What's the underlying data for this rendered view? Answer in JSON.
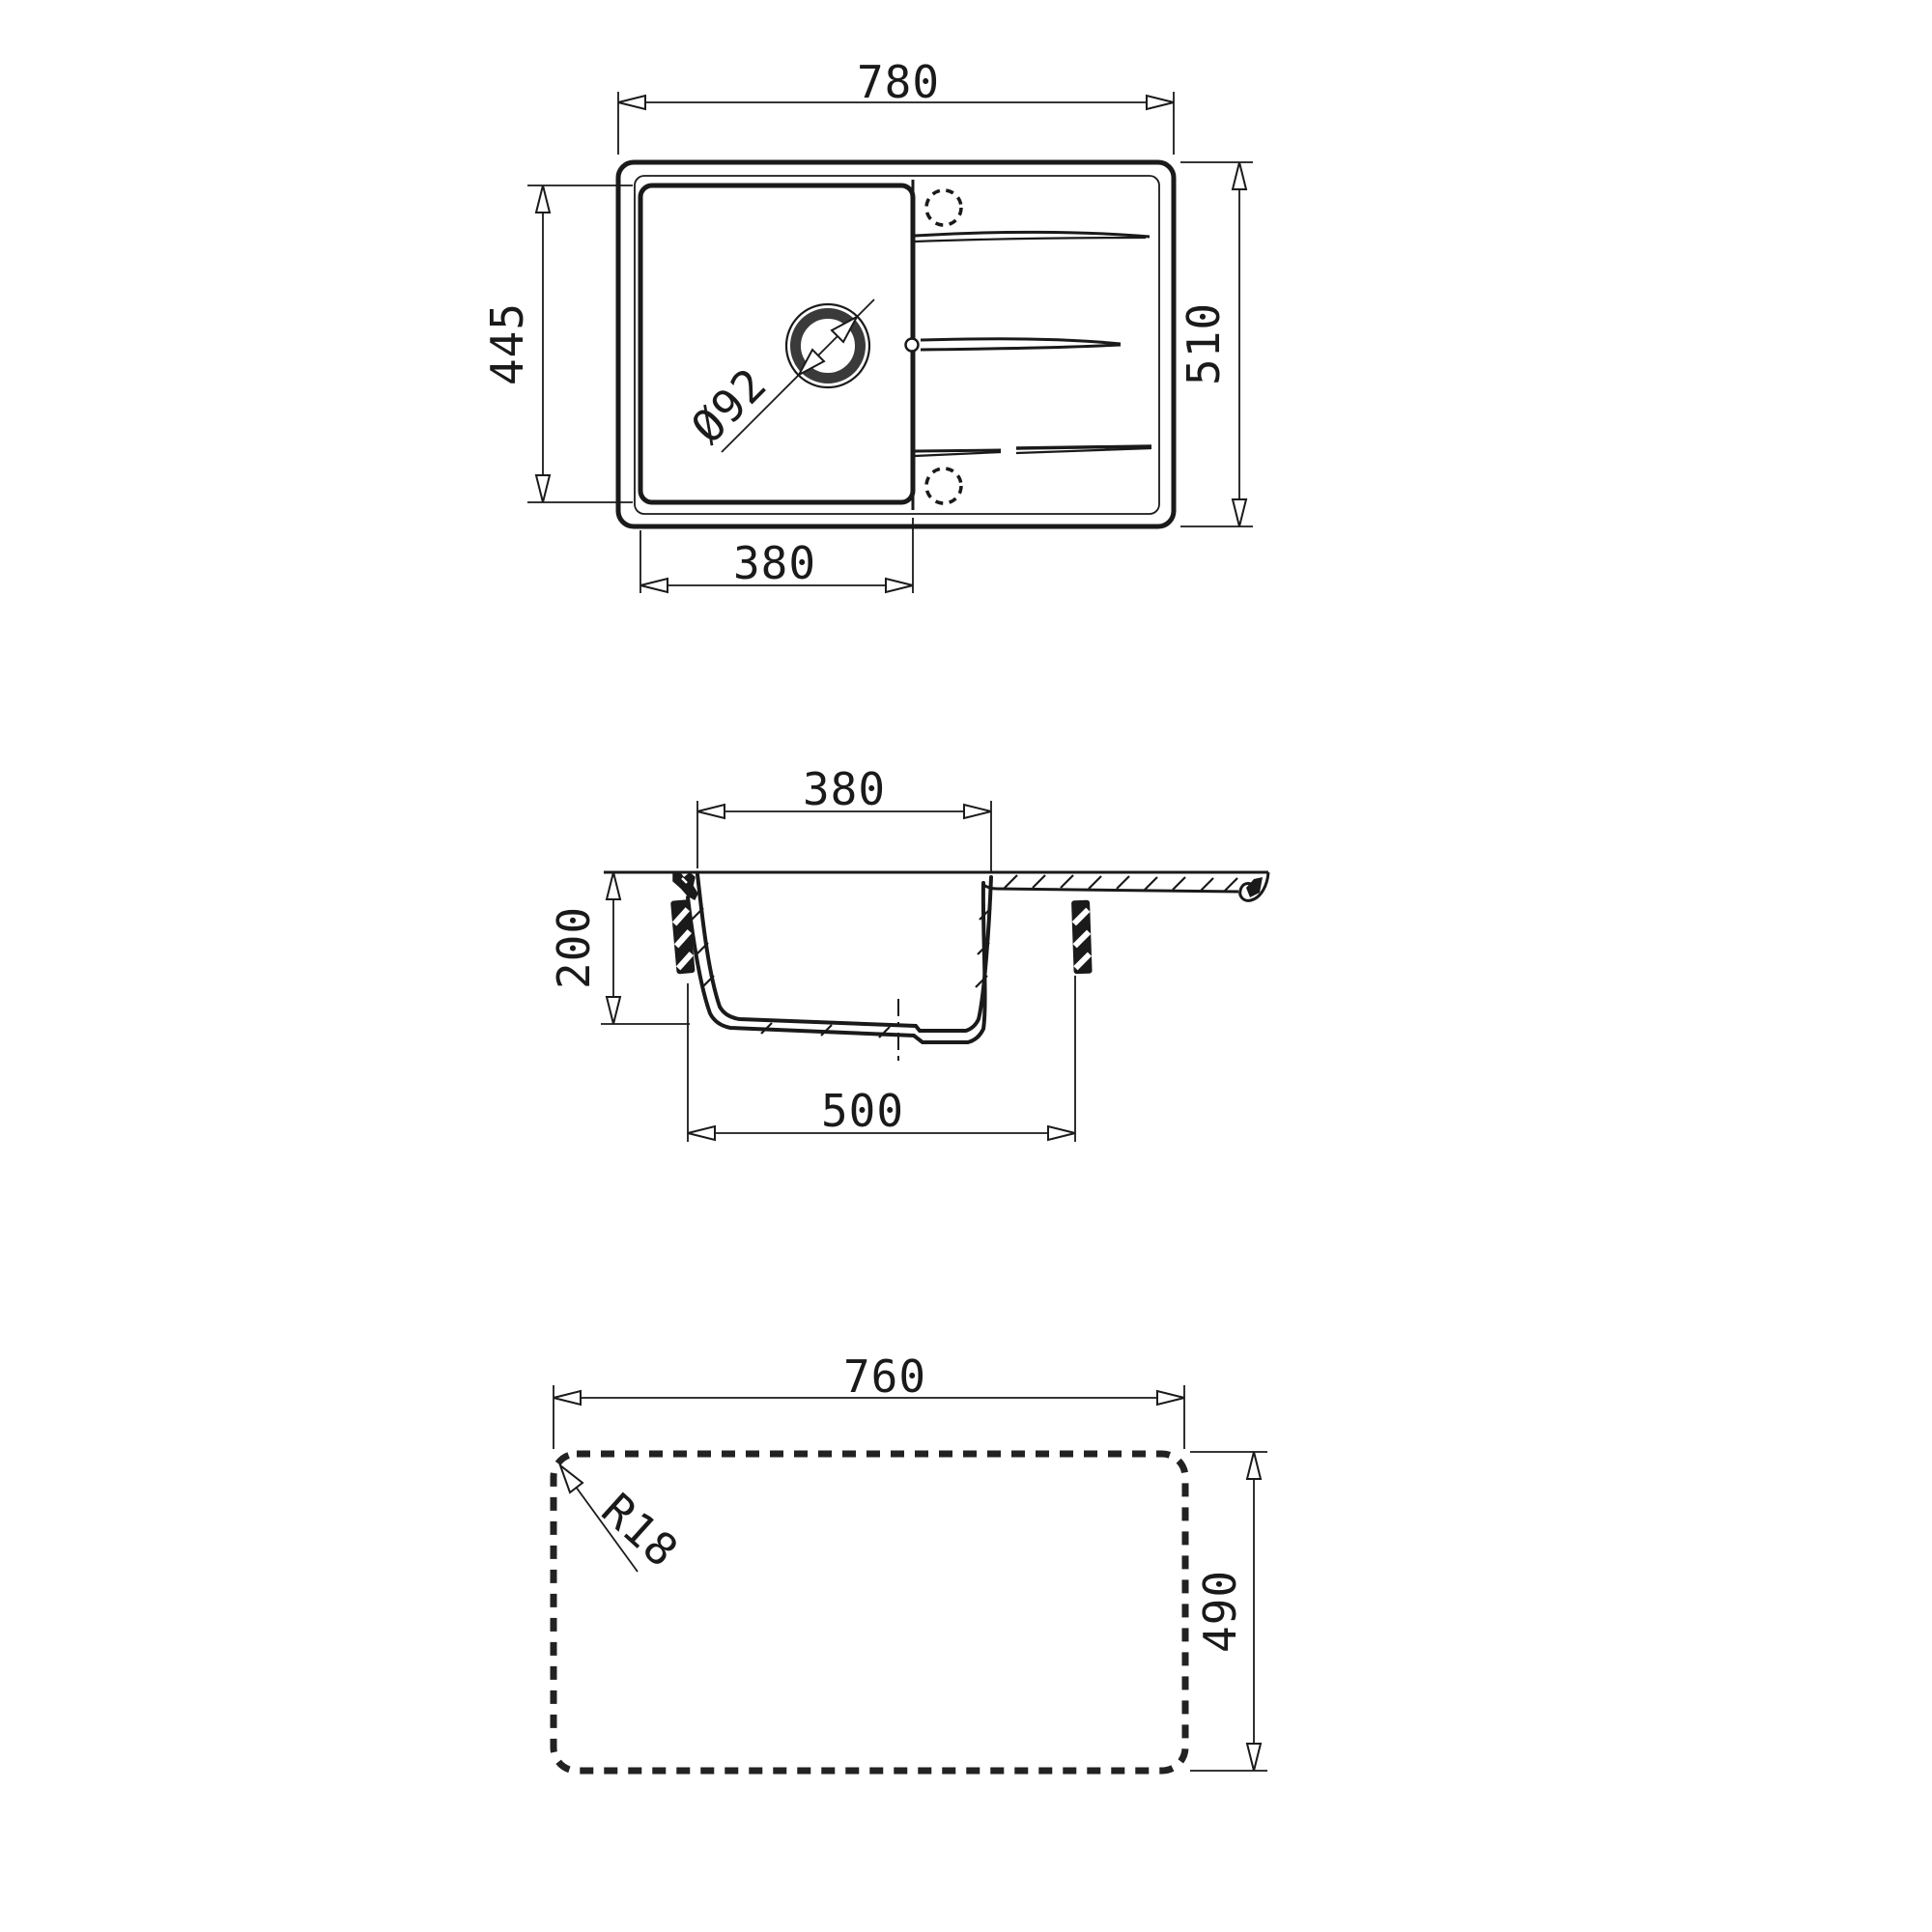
{
  "drawing": {
    "type": "kitchen-sink-technical-drawing",
    "colors": {
      "line": "#1a1a1a",
      "background": "#ffffff"
    },
    "dimensions": {
      "top_view": {
        "overall_width": "780",
        "overall_depth": "510",
        "bowl_length": "445",
        "bowl_width": "380",
        "drain_diameter": "Ø92"
      },
      "section_view": {
        "bowl_top_width": "380",
        "bowl_depth": "200",
        "bowl_bottom_width": "500"
      },
      "cutout_view": {
        "cutout_width": "760",
        "cutout_depth": "490",
        "corner_radius": "R18"
      }
    }
  }
}
